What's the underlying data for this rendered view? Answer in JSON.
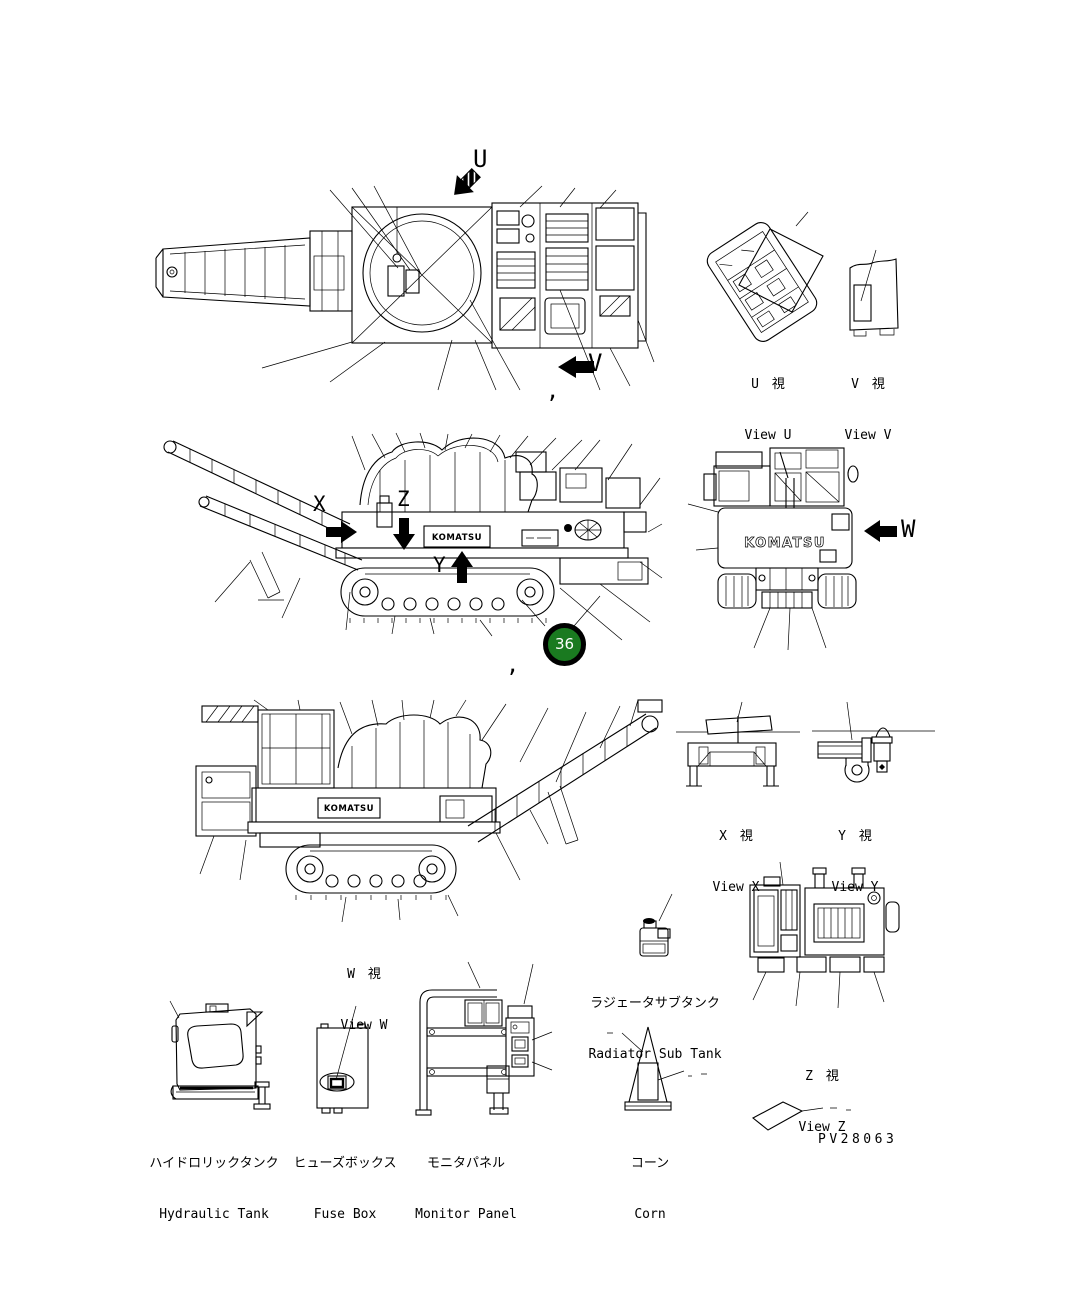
{
  "page": {
    "background": "#ffffff",
    "line_color": "#000000",
    "part_number": "PV28063"
  },
  "brand": {
    "logo": "KOMATSU"
  },
  "callout": {
    "number": "36",
    "fill": "#1a7a20",
    "ring": "#000000",
    "text_color": "#ffffff"
  },
  "direction_markers": {
    "u": "U",
    "v": "V",
    "w": "W",
    "x": "X",
    "y": "Y",
    "z": "Z"
  },
  "view_labels": {
    "u": {
      "jp": "U　視",
      "en": "View U"
    },
    "v": {
      "jp": "V　視",
      "en": "View V"
    },
    "w": {
      "jp": "W　視",
      "en": "View W"
    },
    "x": {
      "jp": "X　視",
      "en": "View X"
    },
    "y": {
      "jp": "Y　視",
      "en": "View Y"
    },
    "z": {
      "jp": "Z　視",
      "en": "View Z"
    }
  },
  "part_labels": {
    "hydraulic_tank": {
      "jp": "ハイドロリックタンク",
      "en": "Hydraulic Tank"
    },
    "fuse_box": {
      "jp": "ヒューズボックス",
      "en": "Fuse Box"
    },
    "monitor_panel": {
      "jp": "モニタパネル",
      "en": "Monitor Panel"
    },
    "radiator_sub_tank": {
      "jp": "ラジェータサブタンク",
      "en": "Radiator Sub Tank"
    },
    "corn": {
      "jp": "コーン",
      "en": "Corn"
    }
  },
  "punctuation": {
    "comma_upper": ",",
    "comma_middle": ","
  }
}
